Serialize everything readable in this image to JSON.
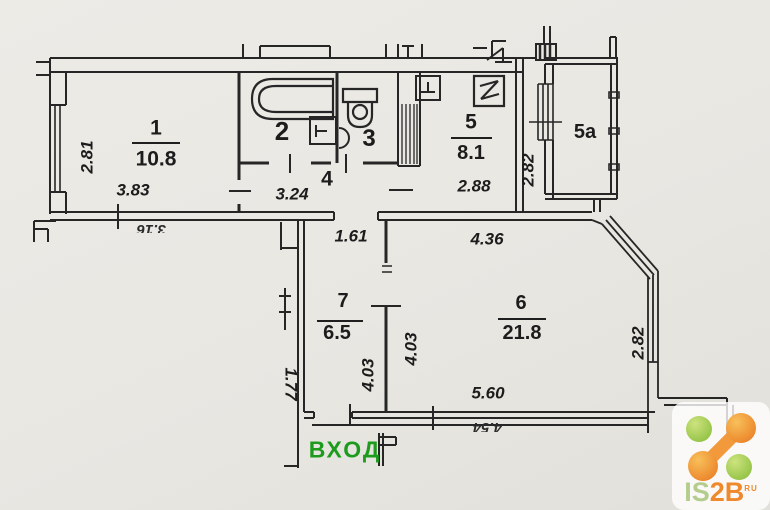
{
  "rooms": {
    "r1": {
      "num": "1",
      "area": "10.8"
    },
    "r2": {
      "num": "2"
    },
    "r3": {
      "num": "3"
    },
    "r4": {
      "num": "4"
    },
    "r5": {
      "num": "5",
      "area": "8.1"
    },
    "r5a": {
      "num": "5a"
    },
    "r6": {
      "num": "6",
      "area": "21.8"
    },
    "r7": {
      "num": "7",
      "area": "6.5"
    }
  },
  "dims": {
    "room1_height": "2.81",
    "room1_width": "3.83",
    "hall": "3.24",
    "corridor": "1.61",
    "kitchen_width": "2.88",
    "kitchen_height": "2.82",
    "room6_top": "4.36",
    "room6_height": "4.03",
    "room7_height": "4.03",
    "room6_bottom": "5.60",
    "bay_height": "2.82",
    "neighbor_height": "1.77",
    "neighbor_cut_left": "3.16",
    "neighbor_cut_right": "4.54"
  },
  "entrance": {
    "label": "ВХОД",
    "color": "#1c9b1c"
  },
  "logo": {
    "part1": "IS",
    "part2": "2B",
    "suffix": "RU"
  },
  "colors": {
    "paper": "#e9e7e2",
    "ink": "#262626",
    "logo_green": "#8cbf3f",
    "logo_orange": "#ea7d24"
  }
}
